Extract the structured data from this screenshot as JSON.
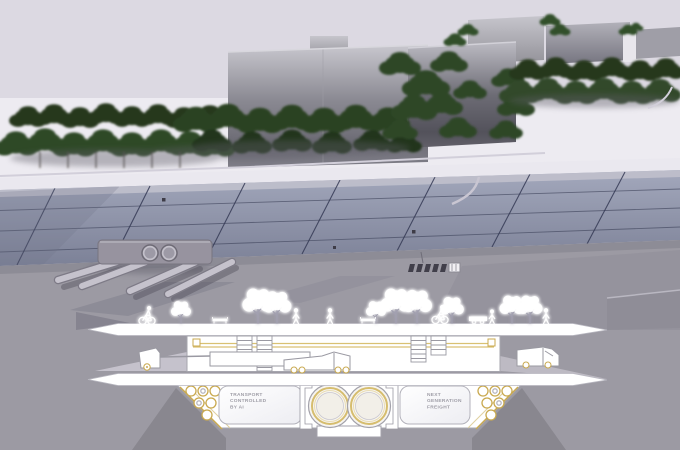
{
  "section_labels": {
    "left_panel": "TRANSPORT\nCONTROLLED\nBY AI",
    "right_panel": "NEXT\nGENERATION\nFREIGHT"
  },
  "palette": {
    "background": "#dcd9e2",
    "earth_gray": "#9c9aa3",
    "plaza_deck": "#8d92a8",
    "plaza_grid_line": "#353a55",
    "foliage_green": "#2d4526",
    "accent_gold": "#c9a94f",
    "section_linework": "#a6a5ae",
    "section_fill": "#ffffff"
  }
}
